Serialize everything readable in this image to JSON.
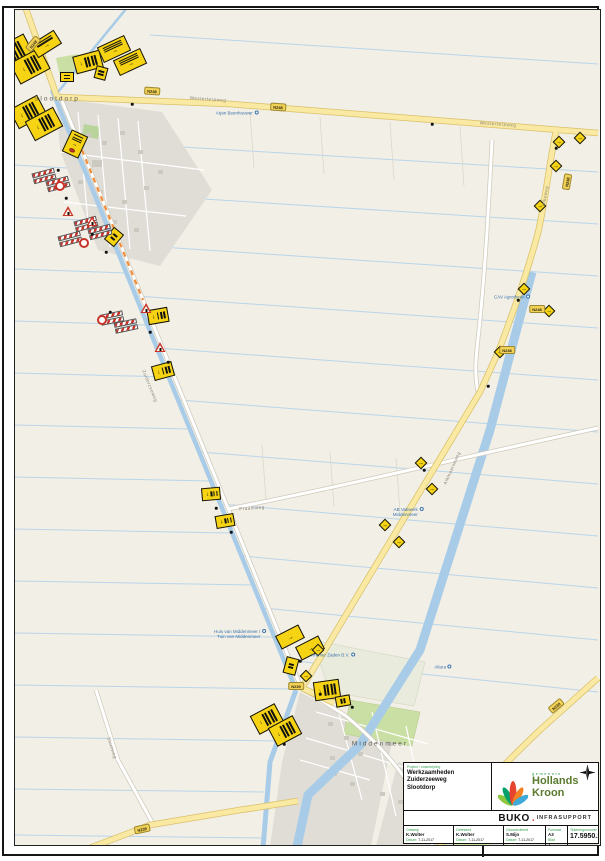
{
  "title_block": {
    "project_label": "Project / omschrijving",
    "project_lines": [
      "Werkzaamheden",
      "Zuiderzeeweg",
      "Slootdorp"
    ],
    "municipality": {
      "small": "gemeente",
      "line1": "Hollands",
      "line2": "Kroon"
    },
    "company": {
      "name": "BUKO",
      "dot": ".",
      "suffix": "INFRASUPPORT"
    },
    "fields": [
      {
        "label": "Ontwerp",
        "value": "K.Wolter",
        "date_label": "Datum:",
        "date": "7-11-2017"
      },
      {
        "label": "Getekend",
        "value": "K.Wolter",
        "date_label": "Datum:",
        "date": "7-11-2017"
      },
      {
        "label": "Gecontroleerd",
        "value": "S.Mijn",
        "date_label": "Datum:",
        "date": "7-11-2017"
      }
    ],
    "format_label": "Formaat",
    "format_value": "A3",
    "sheet_label": "Blad",
    "sheet_value": "1",
    "drawing_number_label": "Tekeningnummer",
    "drawing_number": "17.5950.1"
  },
  "map": {
    "places": [
      {
        "x": 57,
        "y": 99,
        "text": "Slootdorp"
      },
      {
        "x": 380,
        "y": 744,
        "text": "Middenmeer"
      }
    ],
    "pois": [
      {
        "x": 237,
        "y": 113,
        "lines": [
          "Arjan Beenhouwer"
        ]
      },
      {
        "x": 512,
        "y": 297,
        "lines": [
          "CAV Agrotheek"
        ]
      },
      {
        "x": 408,
        "y": 512,
        "lines": [
          "AB Vakwerk",
          "Middenmeer"
        ]
      },
      {
        "x": 333,
        "y": 655,
        "lines": [
          "Kramer Zaden B.V."
        ]
      },
      {
        "x": 240,
        "y": 634,
        "lines": [
          "Huis van Middenmeer /",
          "Tuin van Middenmeer"
        ]
      },
      {
        "x": 443,
        "y": 667,
        "lines": [
          "Altura"
        ]
      }
    ],
    "road_labels": [
      {
        "x": 208,
        "y": 99,
        "r": 4,
        "text": "Westerterpweg"
      },
      {
        "x": 498,
        "y": 124,
        "r": 4,
        "text": "Westerterpweg"
      },
      {
        "x": 150,
        "y": 386,
        "r": 68,
        "text": "Zuiderzeeweg"
      },
      {
        "x": 545,
        "y": 196,
        "r": -80,
        "text": "Ulkeweg"
      },
      {
        "x": 452,
        "y": 468,
        "r": -66,
        "text": "Alkmaarseweg"
      },
      {
        "x": 252,
        "y": 508,
        "r": -4,
        "text": "Praamweg"
      },
      {
        "x": 112,
        "y": 748,
        "r": 72,
        "text": "Slootweg"
      }
    ],
    "shields": [
      {
        "x": 33,
        "y": 44,
        "r": -50,
        "text": "N248"
      },
      {
        "x": 152,
        "y": 91,
        "r": 4,
        "text": "N248"
      },
      {
        "x": 278,
        "y": 107,
        "r": 4,
        "text": "N248"
      },
      {
        "x": 567,
        "y": 182,
        "r": -80,
        "text": "N248"
      },
      {
        "x": 537,
        "y": 309,
        "r": 0,
        "text": "N248"
      },
      {
        "x": 507,
        "y": 350,
        "r": 0,
        "text": "N248"
      },
      {
        "x": 296,
        "y": 686,
        "r": 0,
        "text": "N239"
      },
      {
        "x": 142,
        "y": 829,
        "r": -12,
        "text": "N239"
      },
      {
        "x": 556,
        "y": 706,
        "r": -40,
        "text": "N239"
      }
    ],
    "signs": {
      "boards": [
        {
          "x": 14,
          "y": 52,
          "w": 24,
          "h": 34,
          "r": 62,
          "bars": 4
        },
        {
          "x": 30,
          "y": 66,
          "w": 24,
          "h": 34,
          "r": 62,
          "bars": 4
        },
        {
          "x": 46,
          "y": 44,
          "w": 28,
          "h": 16,
          "r": -32,
          "bars": 3
        },
        {
          "x": 88,
          "y": 62,
          "w": 18,
          "h": 28,
          "r": 75,
          "bars": 4
        },
        {
          "x": 114,
          "y": 49,
          "w": 30,
          "h": 17,
          "r": -25,
          "bars": 3
        },
        {
          "x": 130,
          "y": 62,
          "w": 30,
          "h": 17,
          "r": -25,
          "bars": 3
        },
        {
          "x": 101,
          "y": 73,
          "w": 12,
          "h": 13,
          "r": 15,
          "bars": 2
        },
        {
          "x": 67,
          "y": 77,
          "w": 14,
          "h": 10,
          "r": 0,
          "bars": 2
        },
        {
          "x": 28,
          "y": 112,
          "w": 22,
          "h": 32,
          "r": 62,
          "bars": 4
        },
        {
          "x": 44,
          "y": 124,
          "w": 22,
          "h": 32,
          "r": 62,
          "bars": 4
        },
        {
          "x": 75,
          "y": 144,
          "w": 18,
          "h": 24,
          "r": 25,
          "bars": 3,
          "reddot": true
        },
        {
          "x": 114,
          "y": 237,
          "w": 13,
          "h": 16,
          "r": 40,
          "bars": 2
        },
        {
          "x": 158,
          "y": 316,
          "w": 15,
          "h": 21,
          "r": 80,
          "bars": 3
        },
        {
          "x": 163,
          "y": 371,
          "w": 15,
          "h": 21,
          "r": 75,
          "bars": 3
        },
        {
          "x": 211,
          "y": 494,
          "w": 13,
          "h": 19,
          "r": 85,
          "bars": 3
        },
        {
          "x": 225,
          "y": 521,
          "w": 13,
          "h": 19,
          "r": 80,
          "bars": 3
        },
        {
          "x": 290,
          "y": 637,
          "w": 26,
          "h": 15,
          "r": -27,
          "bars": 3
        },
        {
          "x": 310,
          "y": 648,
          "w": 26,
          "h": 15,
          "r": -27,
          "bars": 3
        },
        {
          "x": 291,
          "y": 666,
          "w": 13,
          "h": 17,
          "r": 15,
          "bars": 2
        },
        {
          "x": 327,
          "y": 690,
          "w": 19,
          "h": 26,
          "r": 82,
          "bars": 4
        },
        {
          "x": 343,
          "y": 701,
          "w": 11,
          "h": 15,
          "r": 80,
          "bars": 2
        },
        {
          "x": 267,
          "y": 719,
          "w": 21,
          "h": 28,
          "r": 62,
          "bars": 4
        },
        {
          "x": 285,
          "y": 731,
          "w": 21,
          "h": 28,
          "r": 62,
          "bars": 4
        }
      ],
      "diamonds": [
        {
          "x": 559,
          "y": 142
        },
        {
          "x": 580,
          "y": 138
        },
        {
          "x": 556,
          "y": 166
        },
        {
          "x": 540,
          "y": 206
        },
        {
          "x": 524,
          "y": 289
        },
        {
          "x": 549,
          "y": 311
        },
        {
          "x": 500,
          "y": 352
        },
        {
          "x": 421,
          "y": 463
        },
        {
          "x": 432,
          "y": 489
        },
        {
          "x": 385,
          "y": 525
        },
        {
          "x": 399,
          "y": 542
        },
        {
          "x": 318,
          "y": 650
        },
        {
          "x": 306,
          "y": 676
        }
      ],
      "barriers": [
        {
          "x": 44,
          "y": 176,
          "r": -15
        },
        {
          "x": 58,
          "y": 184,
          "r": -15
        },
        {
          "x": 86,
          "y": 224,
          "r": -15
        },
        {
          "x": 100,
          "y": 232,
          "r": -15
        },
        {
          "x": 70,
          "y": 239,
          "r": -15
        },
        {
          "x": 112,
          "y": 318,
          "r": -12
        },
        {
          "x": 126,
          "y": 326,
          "r": -12
        }
      ],
      "rings": [
        {
          "x": 60,
          "y": 186
        },
        {
          "x": 84,
          "y": 243
        },
        {
          "x": 102,
          "y": 320
        }
      ],
      "triangles": [
        {
          "x": 68,
          "y": 211
        },
        {
          "x": 92,
          "y": 221
        },
        {
          "x": 146,
          "y": 308
        },
        {
          "x": 160,
          "y": 347
        }
      ],
      "dots": [
        {
          "x": 58,
          "y": 170
        },
        {
          "x": 66,
          "y": 198
        },
        {
          "x": 92,
          "y": 234
        },
        {
          "x": 106,
          "y": 252
        },
        {
          "x": 110,
          "y": 312
        },
        {
          "x": 150,
          "y": 332
        },
        {
          "x": 168,
          "y": 362
        },
        {
          "x": 216,
          "y": 508
        },
        {
          "x": 231,
          "y": 532
        },
        {
          "x": 300,
          "y": 661
        },
        {
          "x": 320,
          "y": 694
        },
        {
          "x": 352,
          "y": 707
        },
        {
          "x": 284,
          "y": 744
        },
        {
          "x": 132,
          "y": 104
        },
        {
          "x": 432,
          "y": 124
        },
        {
          "x": 556,
          "y": 148
        },
        {
          "x": 518,
          "y": 300
        },
        {
          "x": 488,
          "y": 386
        },
        {
          "x": 424,
          "y": 470
        }
      ]
    }
  },
  "colors": {
    "sign_yellow": "#f6d413",
    "sign_red": "#c8342a",
    "water": "#a8cce8",
    "road_yellow": "#f9e9a2",
    "brand_green": "#5a7a2e",
    "buko_red": "#e03c31",
    "label_green": "#2e9e47",
    "map_bg": "#f2efe6"
  }
}
